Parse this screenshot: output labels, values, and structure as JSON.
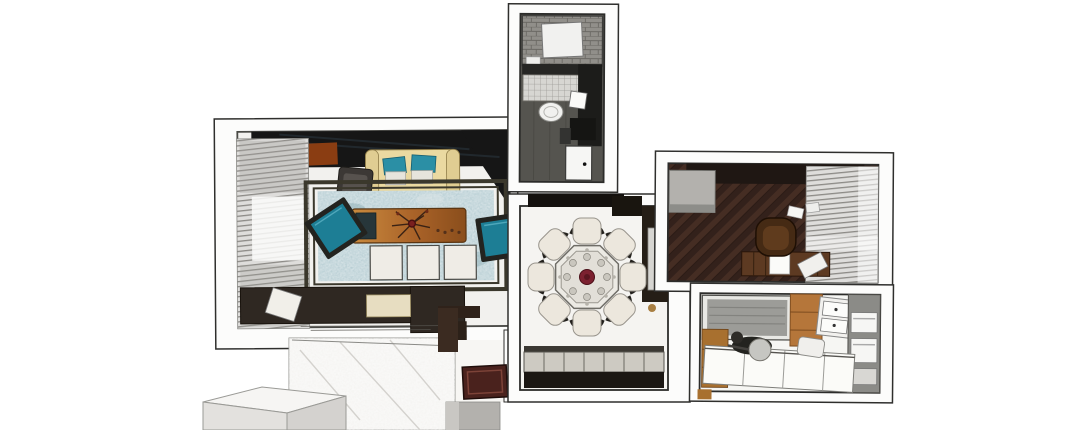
{
  "app": {
    "title": "3D Apartment Floor Plan Render",
    "view": "top-down-axonometric",
    "render_style": "sketchup-like"
  },
  "rooms": [
    {
      "id": "living-room",
      "furniture": [
        "window-blinds",
        "media-wall",
        "wood-accent-panel",
        "beige-sofa",
        "teal-pillows",
        "white-pillows",
        "dark-armchair",
        "distressed-teal-rug",
        "wood-coffee-table",
        "branch-centerpiece",
        "teal-accent-chair-left",
        "teal-accent-chair-right",
        "white-ottoman-x3",
        "dark-sectional-sofa",
        "cream-seat-cushion"
      ]
    },
    {
      "id": "bathroom",
      "furniture": [
        "shower-tiled",
        "shower-tray",
        "mosaic-wall-band",
        "plank-floor",
        "toilet",
        "dark-vanity",
        "sink",
        "door"
      ]
    },
    {
      "id": "study",
      "furniture": [
        "dark-wardrobe",
        "gray-cabinet",
        "herringbone-wood-floor",
        "desk",
        "desk-drawers",
        "paper-sheet",
        "desk-chair",
        "loose-papers",
        "window-blinds"
      ]
    },
    {
      "id": "dining-room",
      "furniture": [
        "octagonal-dining-table",
        "dining-chair-x8",
        "red-centerpiece",
        "dark-sideboard",
        "light-wall-panel",
        "tiled-balcony-strip",
        "dark-bench"
      ]
    },
    {
      "id": "kitchen",
      "furniture": [
        "framed-gray-panel",
        "wood-wall-cabinet",
        "double-basin-sink",
        "tall-appliance-column",
        "built-in-ovens",
        "white-counter-cabinets",
        "cooktop",
        "frying-pan",
        "pot",
        "kettle",
        "wood-drawer-unit"
      ]
    },
    {
      "id": "entry-hall",
      "furniture": [
        "marble-floor",
        "red-doormat",
        "dark-wall-return",
        "gray-plinth-block",
        "white-wall-box"
      ]
    }
  ],
  "colors": {
    "background": "#ffffff",
    "wall": "#fcfcfb",
    "line": "#2f2f2d",
    "innerline": "#4a4a46",
    "marbleFloor": "#f2f1ee",
    "mediaWall": "#161616",
    "woodAccent": "#8a3d12",
    "sofaBeige": "#ead9a1",
    "pillowTeal": "#2b8fa5",
    "pillowWhite": "#e6e4dc",
    "rugTeal": "#a6c2c9",
    "rugBorder": "#3b382c",
    "tableWoodDark": "#8a4e1c",
    "tableWoodLight": "#c98a3e",
    "chairTeal": "#1d7e95",
    "chairFrame": "#23231f",
    "stoolWhite": "#efece6",
    "sectionalDark": "#2f2822",
    "seatCream": "#e7ddc1",
    "doormat": "#4a221d",
    "doormatBorder": "#7d4338",
    "bathFloor": "#55544f",
    "showerTile": "#918f8a",
    "mosaicTile": "#d7d6d2",
    "vanityDark": "#1c1c1a",
    "porcelain": "#f1f1ef",
    "wardrobeDark": "#1f1713",
    "cabinetGray": "#b3b1ad",
    "studyFloorA": "#33211b",
    "studyFloorB": "#452d23",
    "deskWood": "#5d3a22",
    "chairBrown": "#452a14",
    "blindBase": "#dedddb",
    "blindSlat": "#8c8a86",
    "kitchenPanel": "#9c9c98",
    "kitchenWood": "#b5763a",
    "applianceGray": "#8b8b87",
    "counterWhite": "#fbfbf8",
    "stoveDark": "#23231f",
    "panSilver": "#c6c6c2",
    "diningFloor": "#f5f4f1",
    "diningDark": "#251e16",
    "tableTopCream": "#eceae4",
    "chairCream": "#ece7dd",
    "centerRed": "#7c2130",
    "balconyTile": "#cdcac2",
    "balconyDark": "#1b1713",
    "grayBlock": "#b3b1ad",
    "boxTop": "#f6f5f3",
    "boxFront": "#e3e1de"
  }
}
